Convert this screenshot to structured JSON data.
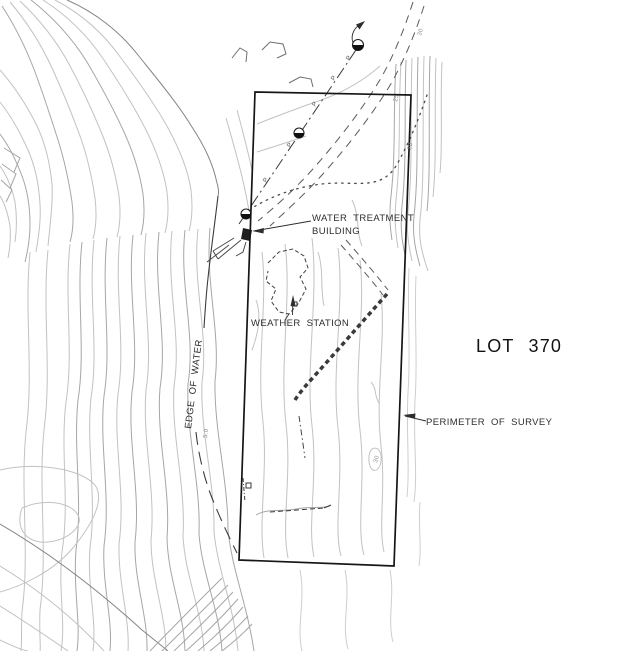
{
  "drawing": {
    "labels": {
      "water_treatment_line1": "WATER TREATMENT",
      "water_treatment_line2": "BUILDING",
      "weather_station": "WEATHER STATION",
      "lot": "LOT 370",
      "perimeter_of_survey": "PERIMETER OF SURVEY",
      "edge_of_water": "EDGE OF WATER"
    },
    "pole_line_marks": [
      {
        "text": "P"
      },
      {
        "text": "P"
      },
      {
        "text": "P"
      },
      {
        "text": "P"
      },
      {
        "text": "P"
      }
    ],
    "contour_elevation_labels": [
      {
        "text": "30"
      },
      {
        "text": "25"
      },
      {
        "text": "30"
      },
      {
        "text": "30"
      },
      {
        "text": "5.0"
      }
    ],
    "symbols": {
      "utility_pole_count": 3,
      "utility_pole_style": "circle-lower-half-filled"
    },
    "colors": {
      "background": "#ffffff",
      "contour_light": "#c2c2c2",
      "contour_medium": "#a6a6a6",
      "contour_dark": "#858585",
      "survey_line": "#161616",
      "feature_line": "#3c3c3c",
      "label_text": "#2e2e2e"
    }
  }
}
